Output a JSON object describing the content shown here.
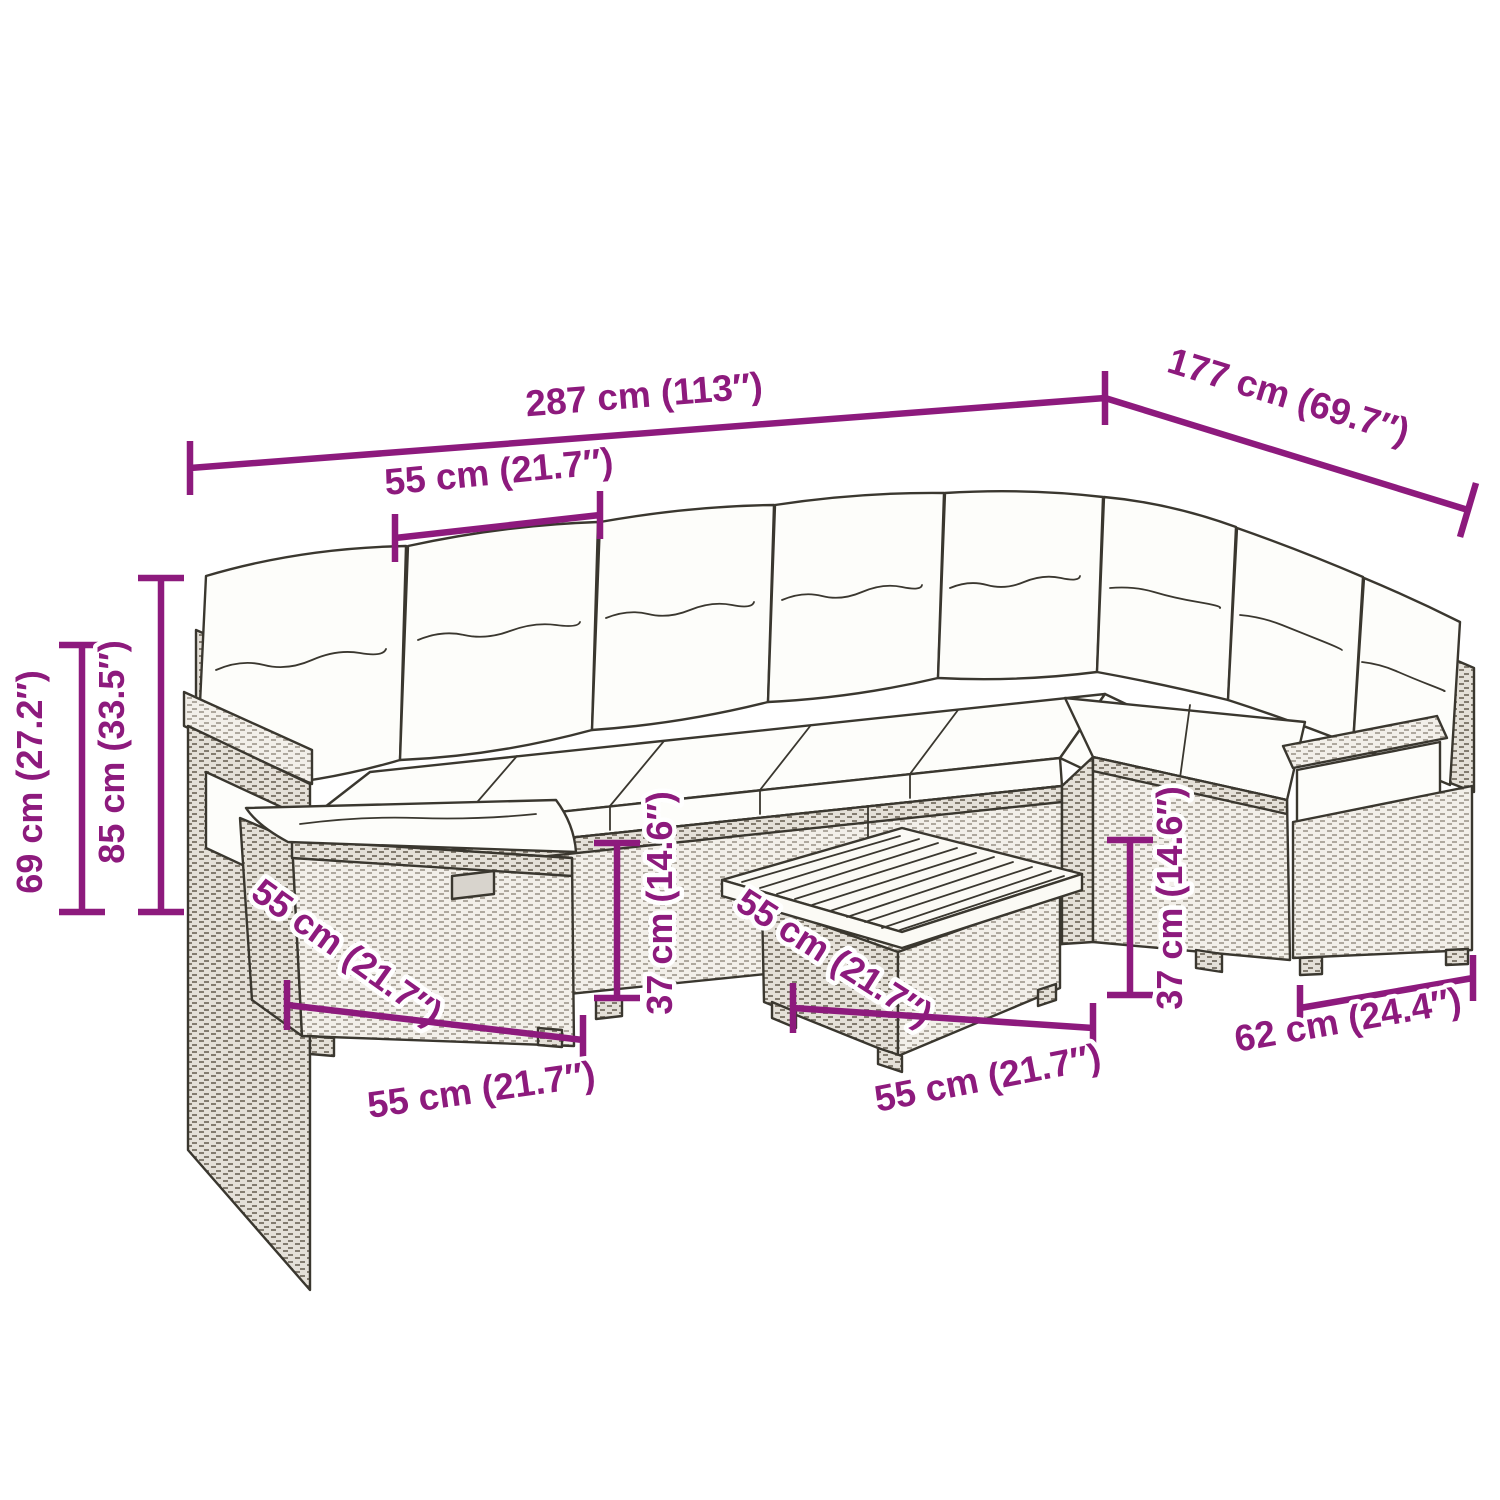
{
  "diagram": {
    "kind": "furniture-dimension-diagram",
    "subject": "poly-rattan L-shaped garden lounge set with cushions, ottoman and wood-top table",
    "colors": {
      "dimension": "#8d1a7d",
      "outline": "#3a372f",
      "cushion": "#fdfdfa",
      "rattan_light": "#f2efe9",
      "rattan_dark": "#e4e0d8",
      "wood": "#fbfaf5",
      "background": "#ffffff"
    },
    "dims": {
      "total_width": "287 cm (113″)",
      "total_depth": "177 cm (69.7″)",
      "seat_module_width": "55 cm (21.7″)",
      "armrest_height": "69 cm (27.2″)",
      "total_height": "85 cm (33.5″)",
      "seat_height_left": "37 cm (14.6″)",
      "seat_height_right": "37 cm (14.6″)",
      "ottoman_depth": "55 cm (21.7″)",
      "ottoman_width": "55 cm (21.7″)",
      "table_depth": "55 cm (21.7″)",
      "table_width": "55 cm (21.7″)",
      "end_module_width": "62 cm (24.4″)"
    }
  }
}
